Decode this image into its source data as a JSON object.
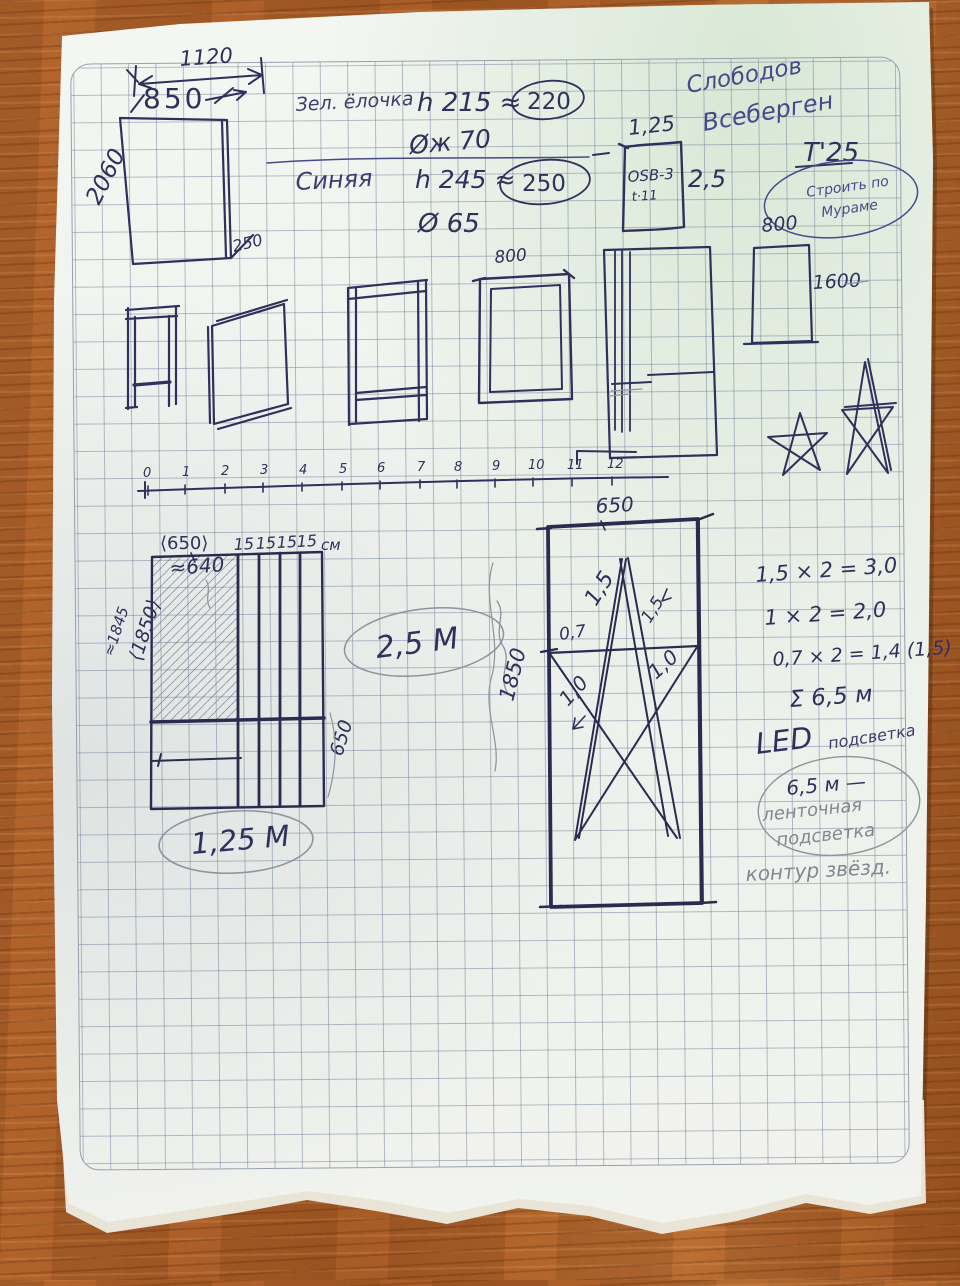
{
  "cabinet": {
    "total_width": "1120",
    "door_width": "850",
    "height": "2060",
    "depth": "250"
  },
  "trees": {
    "green_label": "Зел. ёлочка",
    "green_height": "h 215 ≈",
    "green_height_alt": "220",
    "green_diameter": "Øж 70",
    "blue_label": "Синяя",
    "blue_height": "h 245 ≈",
    "blue_height_alt": "250",
    "blue_diameter": "Ø 65"
  },
  "osb": {
    "width": "1,25",
    "material": "OSB-3",
    "thickness": "t·11",
    "height": "2,5"
  },
  "author": {
    "line1": "Слободов",
    "line2": "Всеберген",
    "date": "Т'25",
    "stamp_line1": "Строить по",
    "stamp_line2": "Мураме"
  },
  "panel1600": {
    "width": "800",
    "height": "1600"
  },
  "frame800": {
    "width": "800"
  },
  "ruler": {
    "labels": [
      "0",
      "1",
      "2",
      "3",
      "4",
      "5",
      "6",
      "7",
      "8",
      "9",
      "10",
      "11",
      "12"
    ]
  },
  "board125": {
    "width": "⟨650⟩",
    "width_approx": "≈640",
    "strip1": "15",
    "strip2": "15",
    "strip3": "15",
    "strip4": "15",
    "unit": "см",
    "height_approx": "≈1845",
    "height": "⟨1850⟩",
    "lower_height": "650",
    "total": "1,25 М"
  },
  "label_25m": "2,5 М",
  "starboard": {
    "width": "650",
    "height": "1850",
    "seg_left": "1,5",
    "seg_right": "1,5",
    "seg_mid": "0,7",
    "seg_bl": "1,0",
    "seg_br": "1,0"
  },
  "calc": {
    "line1": "1,5 × 2 = 3,0",
    "line2": "1 × 2 = 2,0",
    "line3": "0,7 × 2 = 1,4 (1,5)",
    "sum": "Σ 6,5 м",
    "led": "LED",
    "led_note": "подсветка",
    "oval_line1": "6,5 м —",
    "oval_line2": "ленточная",
    "oval_line3": "подсветка",
    "bottom_note": "контур звёзд."
  }
}
